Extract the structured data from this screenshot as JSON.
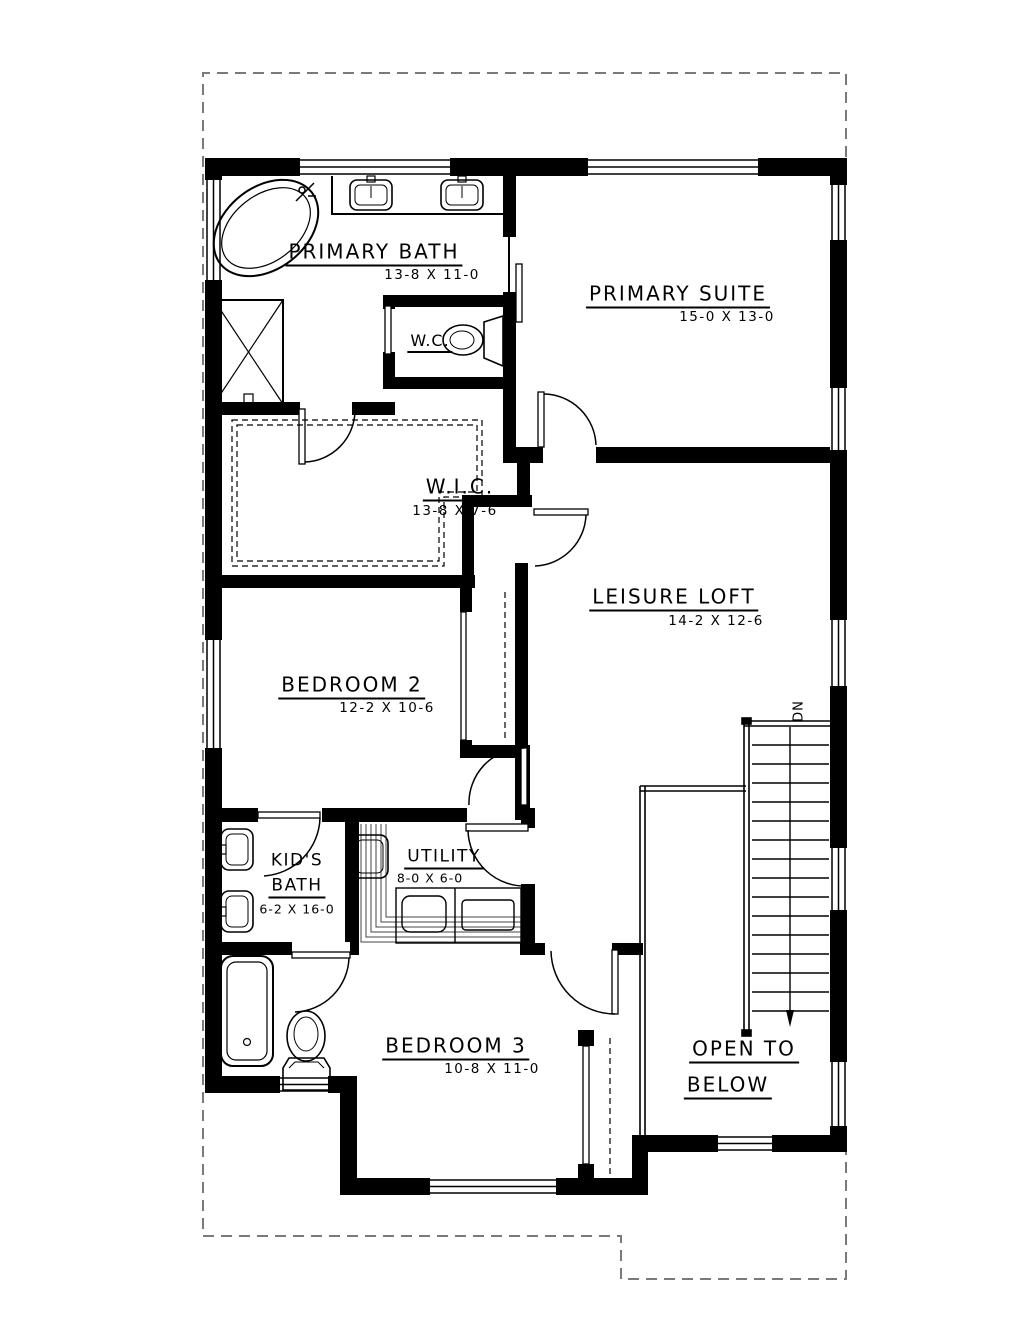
{
  "drawing": {
    "type": "floor-plan",
    "colors": {
      "paper": "#ffffff",
      "ink": "#000000",
      "lot_outline": "#7a7a7a"
    },
    "rooms": [
      {
        "id": "primary-bath",
        "name": "PRIMARY BATH",
        "dims": "13-8 X 11-0"
      },
      {
        "id": "wc",
        "name": "W.C.",
        "dims": ""
      },
      {
        "id": "primary-suite",
        "name": "PRIMARY SUITE",
        "dims": "15-0 X 13-0"
      },
      {
        "id": "wic",
        "name": "W.I.C.",
        "dims": "13-8 X 7-6"
      },
      {
        "id": "leisure-loft",
        "name": "LEISURE LOFT",
        "dims": "14-2 X 12-6"
      },
      {
        "id": "bedroom-2",
        "name": "BEDROOM 2",
        "dims": "12-2 X 10-6"
      },
      {
        "id": "kids-bath",
        "name_line1": "KID'S",
        "name_line2": "BATH",
        "dims": "6-2 X 16-0"
      },
      {
        "id": "utility",
        "name": "UTILITY",
        "dims": "8-0 X 6-0"
      },
      {
        "id": "bedroom-3",
        "name": "BEDROOM 3",
        "dims": "10-8 X 11-0"
      },
      {
        "id": "open-to-below",
        "name_line1": "OPEN TO",
        "name_line2": "BELOW"
      }
    ],
    "stairs": {
      "label": "DN"
    }
  }
}
